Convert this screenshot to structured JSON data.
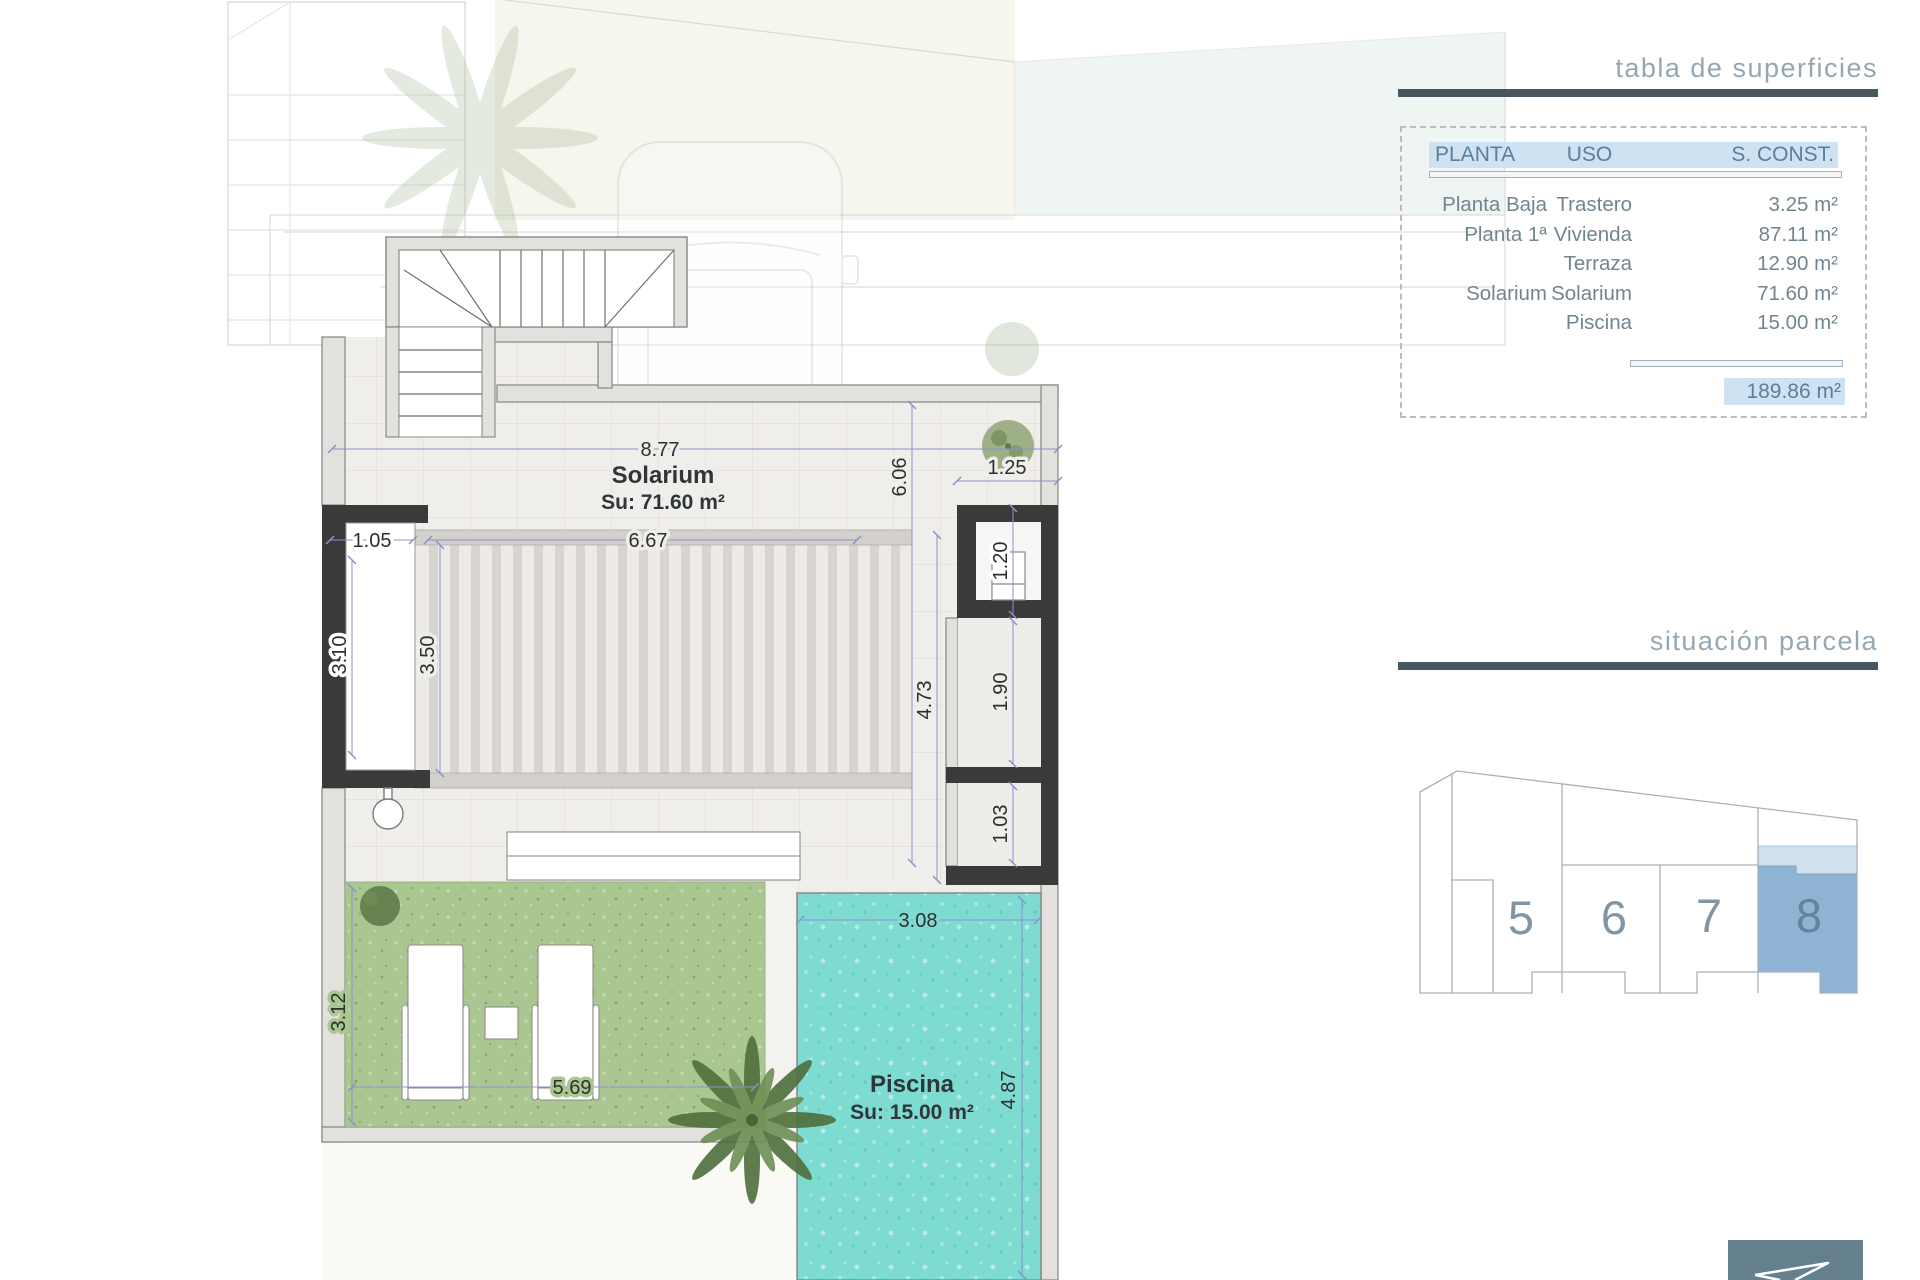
{
  "surfaces_table": {
    "title": "tabla de superficies",
    "headers": {
      "planta": "PLANTA",
      "uso": "USO",
      "sconst": "S. CONST."
    },
    "rows": [
      {
        "planta": "Planta Baja",
        "uso": "Trastero",
        "sconst": "3.25 m²"
      },
      {
        "planta": "Planta 1ª",
        "uso": "Vivienda",
        "sconst": "87.11 m²"
      },
      {
        "planta": "",
        "uso": "Terraza",
        "sconst": "12.90 m²"
      },
      {
        "planta": "Solarium",
        "uso": "Solarium",
        "sconst": "71.60 m²"
      },
      {
        "planta": "",
        "uso": "Piscina",
        "sconst": "15.00 m²"
      }
    ],
    "total": "189.86 m²",
    "header_highlight_color": "#cfe2f2",
    "text_color": "#5b7e99"
  },
  "parcel_map": {
    "title": "situación parcela",
    "parcels": [
      {
        "number": "5"
      },
      {
        "number": "6"
      },
      {
        "number": "7"
      },
      {
        "number": "8",
        "highlighted": true
      }
    ],
    "highlight_color": "#8fb4d3",
    "highlight_band_color": "#cfe0ee"
  },
  "plan": {
    "rooms": {
      "solarium": {
        "name": "Solarium",
        "area": "Su: 71.60 m²"
      },
      "piscina": {
        "name": "Piscina",
        "area": "Su: 15.00 m²"
      }
    },
    "dims": {
      "top_width": "8.77",
      "pergola_width": "6.67",
      "left_opening": "1.05",
      "left_depth": "3.10",
      "pergola_depth": "3.50",
      "right_depth": "6.06",
      "shaft_width": "1.25",
      "shaft_depth": "1.20",
      "terrace_depth": "4.73",
      "room_depth": "1.90",
      "store_depth": "1.03",
      "garden_depth": "3.12",
      "garden_width": "5.69",
      "pool_width": "3.08",
      "pool_depth": "4.87"
    },
    "colors": {
      "wall_dark": "#3a3a3a",
      "deck": "#f0eeeb",
      "grass": "#abc791",
      "water": "#7edbd2",
      "dim_line": "#8b90cc"
    }
  },
  "logo": {
    "color": "#64808f"
  }
}
